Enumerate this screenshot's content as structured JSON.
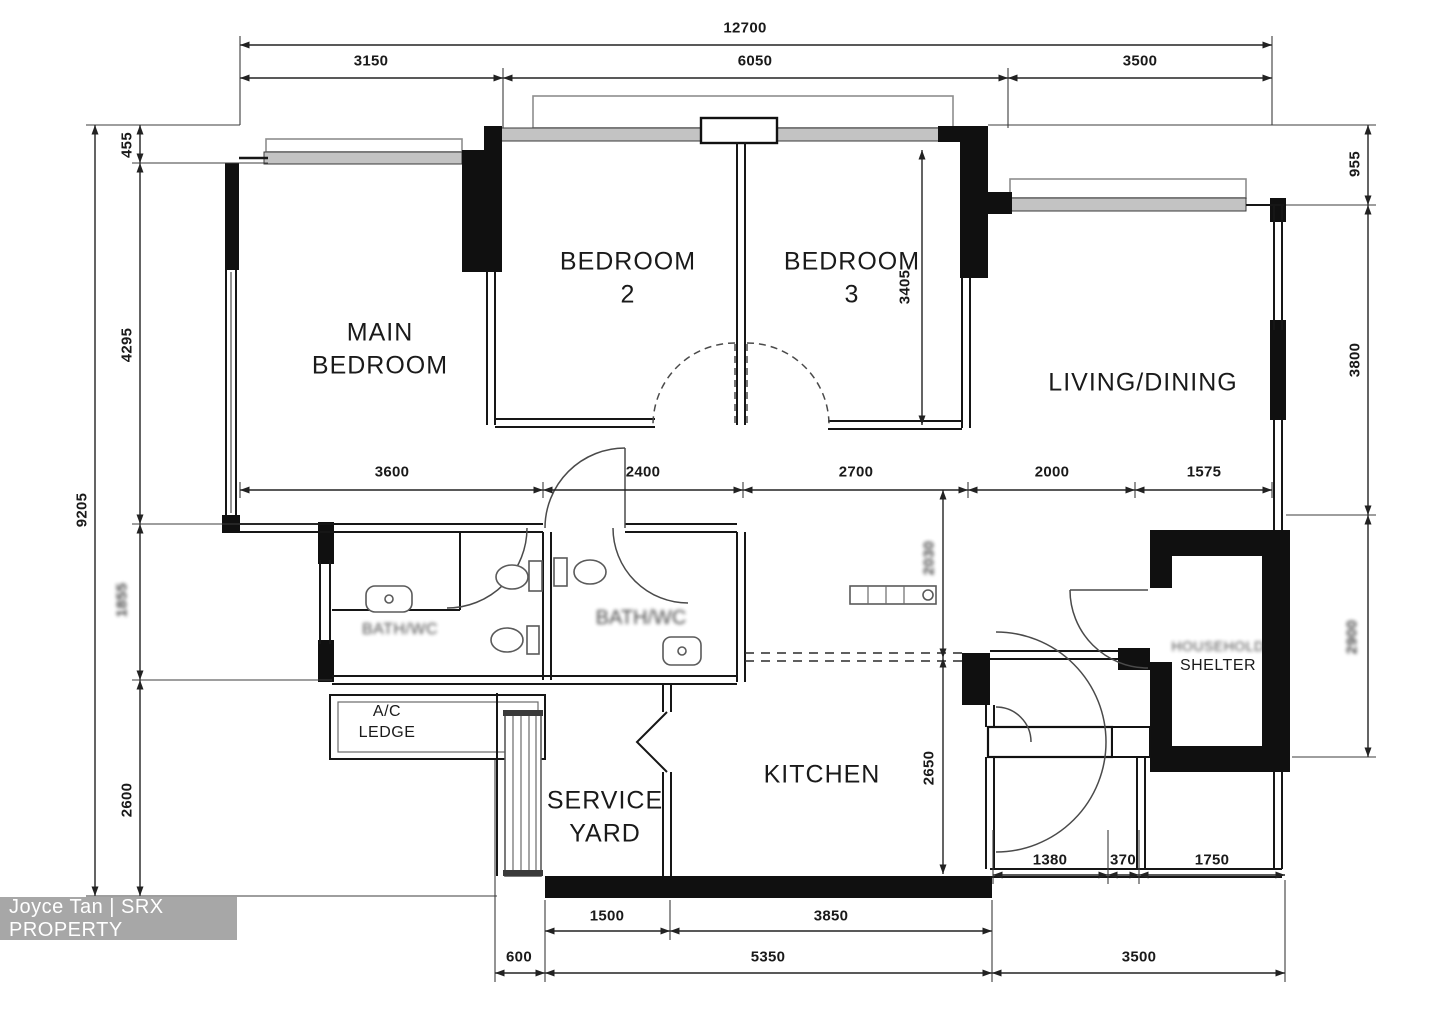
{
  "watermark": {
    "text": "Joyce Tan | SRX PROPERTY"
  },
  "rooms": {
    "main_bedroom": {
      "line1": "MAIN",
      "line2": "BEDROOM"
    },
    "bedroom2": {
      "line1": "BEDROOM",
      "line2": "2"
    },
    "bedroom3": {
      "line1": "BEDROOM",
      "line2": "3"
    },
    "living_dining": {
      "label": "LIVING/DINING"
    },
    "kitchen": {
      "label": "KITCHEN"
    },
    "service_yard": {
      "line1": "SERVICE",
      "line2": "YARD"
    },
    "ac_ledge": {
      "line1": "A/C",
      "line2": "LEDGE"
    },
    "household_shelter": {
      "line1": "HOUSEHOLD",
      "line2": "SHELTER"
    },
    "bath1": {
      "label": "BATH/WC"
    },
    "bath2": {
      "label": "BATH/WC"
    }
  },
  "dims": {
    "top": {
      "overall": "12700",
      "seg1": "3150",
      "seg2": "6050",
      "seg3": "3500"
    },
    "left": {
      "overall": "9205",
      "seg1": "455",
      "seg2": "4295",
      "seg3": "1855",
      "seg4": "2600"
    },
    "right": {
      "seg1": "955",
      "seg2": "3800",
      "seg3": "2900"
    },
    "middle_row": [
      "3600",
      "2400",
      "2700",
      "2000",
      "1575"
    ],
    "interior": {
      "bedroom3_height": "3405",
      "hall_height": "2030",
      "kitchen_height": "2650"
    },
    "entrance_row": [
      "1380",
      "370",
      "1750"
    ],
    "bottom": {
      "row1_seg1": "1500",
      "row1_seg2": "3850",
      "row2_seg1": "600",
      "row2_seg2": "5350",
      "row2_seg3": "3500"
    }
  }
}
